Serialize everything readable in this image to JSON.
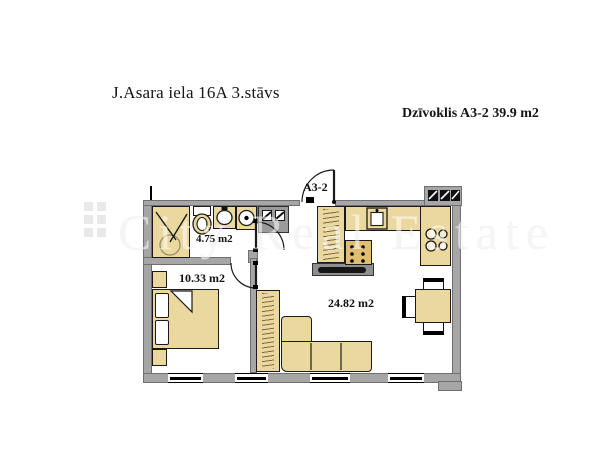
{
  "header": {
    "title": "J.Asara iela 16A 3.stāvs",
    "apartment_label": "Dzīvoklis A3-2 39.9 m2"
  },
  "watermark": {
    "text": "City Real Estate"
  },
  "floor_plan": {
    "entrance_label": "A3-2",
    "rooms": [
      {
        "name": "bathroom",
        "area_label": "4.75 m2"
      },
      {
        "name": "bedroom",
        "area_label": "10.33 m2"
      },
      {
        "name": "living-room",
        "area_label": "24.82 m2"
      }
    ],
    "colors": {
      "wall": "#a6a6a6",
      "furniture": "#ead89f",
      "dark_cabinet": "#dfbe72",
      "outline": "#000000",
      "watermark": "#e9e9e9",
      "background": "#ffffff"
    }
  }
}
